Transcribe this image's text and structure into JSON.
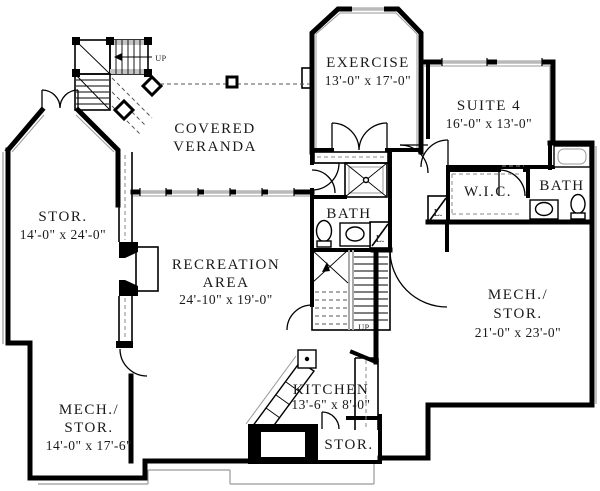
{
  "plan": {
    "title": "basement floor plan",
    "rooms": {
      "veranda": {
        "l1": "COVERED",
        "l2": "VERANDA"
      },
      "exercise": {
        "l1": "EXERCISE",
        "l2": "13'-0\" x 17'-0\""
      },
      "suite4": {
        "l1": "SUITE 4",
        "l2": "16'-0\" x 13'-0\""
      },
      "stor_left": {
        "l1": "STOR.",
        "l2": "14'-0\" x 24'-0\""
      },
      "recreation": {
        "l1": "RECREATION",
        "l2": "AREA",
        "l3": "24'-10\" x 19'-0\""
      },
      "bath_center": {
        "l1": "BATH"
      },
      "wic": {
        "l1": "W.I.C."
      },
      "bath_right": {
        "l1": "BATH"
      },
      "mech_stor_right": {
        "l1": "MECH./",
        "l2": "STOR.",
        "l3": "21'-0\" x 23'-0\""
      },
      "kitchen": {
        "l1": "KITCHEN",
        "l2": "13'-6\" x 8'-0\""
      },
      "mech_stor_left": {
        "l1": "MECH./",
        "l2": "STOR.",
        "l3": "14'-0\" x 17'-6\""
      },
      "stor_bottom": {
        "l1": "STOR."
      }
    },
    "annotations": {
      "up_top": "UP",
      "up_center": "UP",
      "linen_center": "L.",
      "linen_wic": "L."
    },
    "colors": {
      "wall": "#000000",
      "detail_gray": "#9a9a9a",
      "window_gray": "#b9b9b9",
      "background": "#ffffff"
    }
  }
}
